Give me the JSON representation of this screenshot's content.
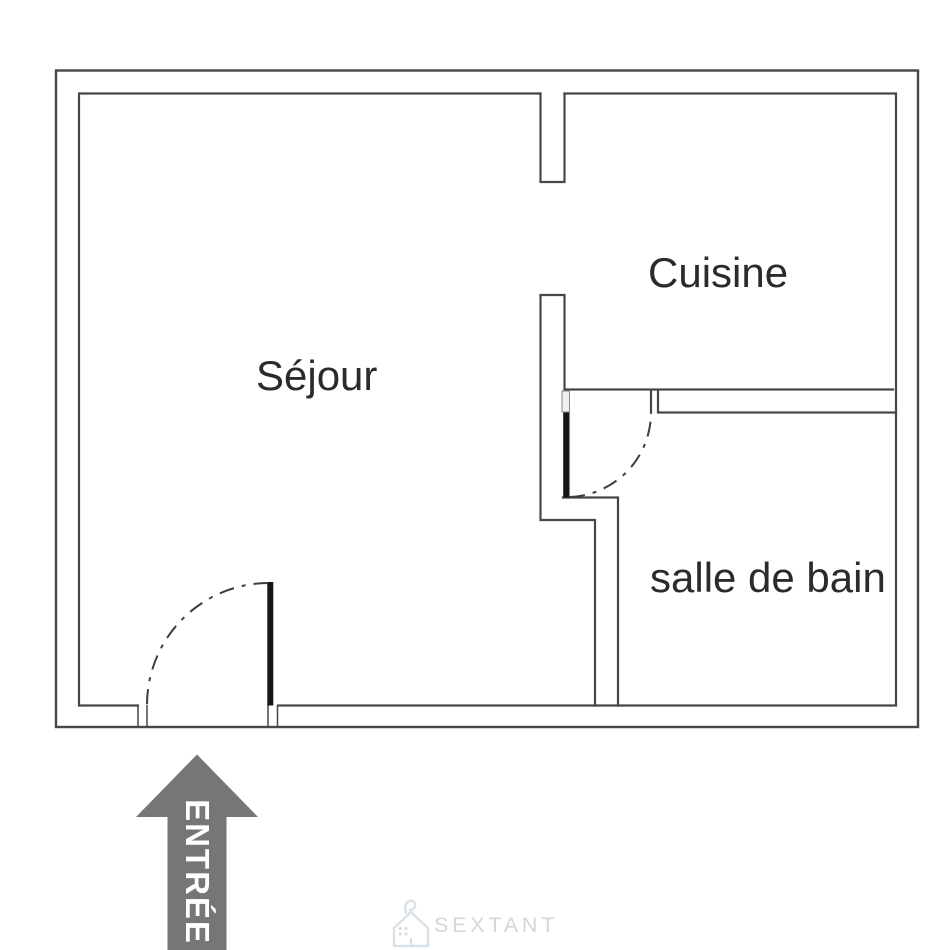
{
  "floorplan": {
    "background": "#ffffff",
    "wall_color": "#474747",
    "jamb_color": "#8a8a8a",
    "door_color": "#161616",
    "swing_color": "#3d3d3d",
    "label_color": "#2b2b2b",
    "rooms": [
      {
        "id": "sejour",
        "label": "Séjour"
      },
      {
        "id": "cuisine",
        "label": "Cuisine"
      },
      {
        "id": "salle_de_bain",
        "label": "salle de bain"
      }
    ],
    "entrance": {
      "label": "ENTRÉE",
      "arrow_color": "#767676",
      "label_color": "#ffffff"
    }
  },
  "branding": {
    "logo_text": "SEXTANT",
    "logo_text_color": "#d2d7da",
    "logo_icon": "house-icon",
    "logo_icon_color": "#d9e2e8"
  }
}
